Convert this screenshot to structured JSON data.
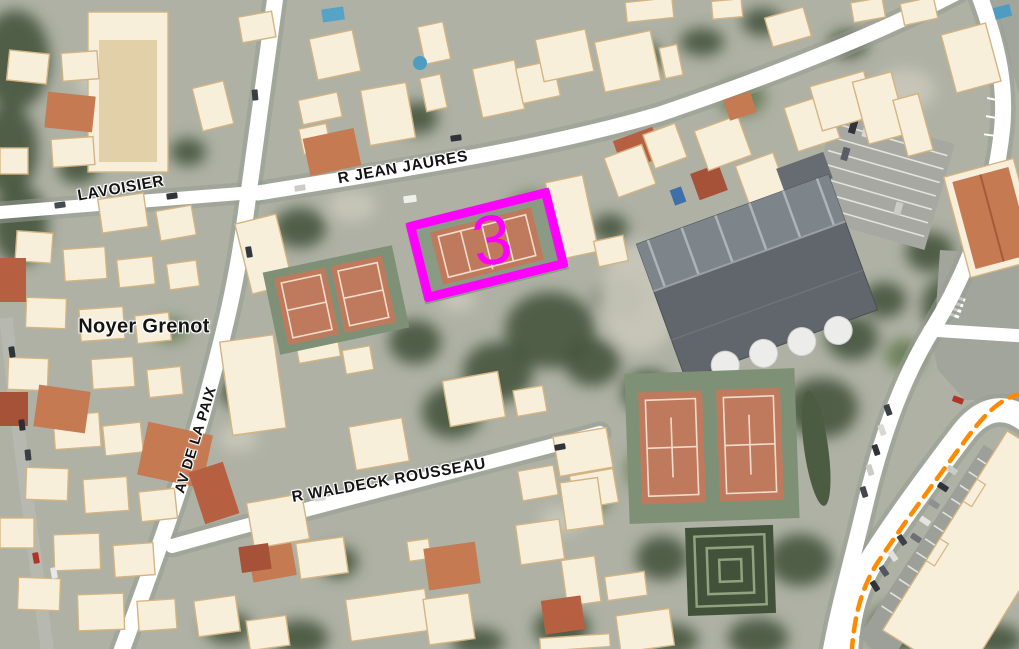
{
  "theme": {
    "highlight": "#ff00ff",
    "road": "#ffffff",
    "building": "#f8efdb",
    "building-outline": "#d3b483",
    "court": "#bf7a5e",
    "court-pad": "#7e9075",
    "label": "#141414",
    "dash": "#ff8a00"
  },
  "map": {
    "street_labels": [
      {
        "id": "lavoisier",
        "text": "LAVOISIER"
      },
      {
        "id": "jean-jaures",
        "text": "R JEAN JAURES"
      },
      {
        "id": "av-de-la-paix",
        "text": "AV DE LA PAIX"
      },
      {
        "id": "waldeck-rousseau",
        "text": "R WALDECK ROUSSEAU"
      }
    ],
    "locality_label": {
      "text": "Noyer Grenot"
    },
    "highlight": {
      "label": "3",
      "color": "#ff00ff"
    }
  }
}
